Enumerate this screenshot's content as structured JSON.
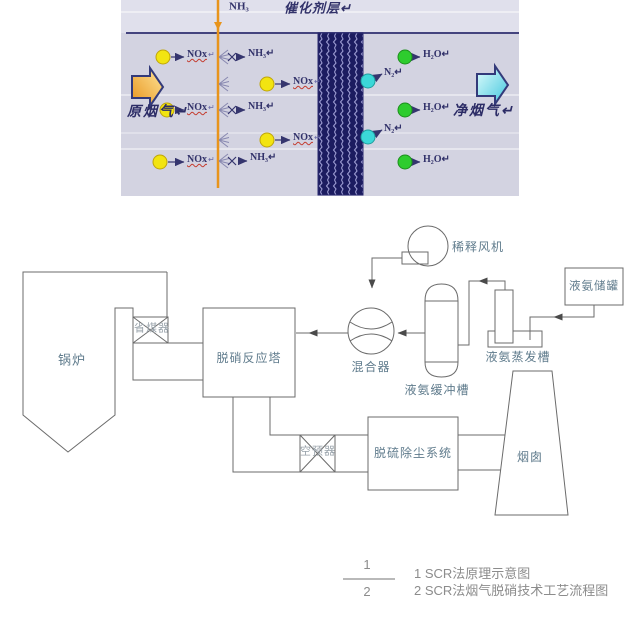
{
  "top_image": {
    "ammonia_injection_label": "NH₃",
    "catalyst_layer_label": "催化剂层↵",
    "raw_flue_gas_label": "原烟气↵",
    "clean_flue_gas_label": "净烟气↵",
    "nox_label": "NOx",
    "nh3_label": "NH₃↵",
    "n2_label": "N₂↵",
    "h2o_label": "H₂O↵",
    "return_mark": "↵",
    "colors": {
      "background": "#d3d3e1",
      "catalyst_block": "#1c1c60",
      "injection_line": "#e8941c",
      "nox_molecule": "#f2e411",
      "n2_molecule": "#3bd8d8",
      "h2o_molecule": "#2ecc2e",
      "raw_gas_arrow": "#eda027",
      "clean_gas_arrow": "#41c6dd",
      "divider_line": "#44447e"
    }
  },
  "flow_diagram": {
    "boiler": "锅炉",
    "economizer": "省煤器",
    "scr_reactor": "脱硝反应塔",
    "mixer": "混合器",
    "dilution_fan": "稀释风机",
    "ammonia_buffer_tank": "液氨缓冲槽",
    "ammonia_evaporator": "液氨蒸发槽",
    "ammonia_storage_tank": "液氨储罐",
    "air_preheater": "空预器",
    "fgd_system": "脱硫除尘系统",
    "stack": "烟囱"
  },
  "caption": {
    "figure_number_top": "1",
    "figure_number_bottom": "2",
    "line1": "1 SCR法原理示意图",
    "line2": "2 SCR法烟气脱硝技术工艺流程图"
  }
}
